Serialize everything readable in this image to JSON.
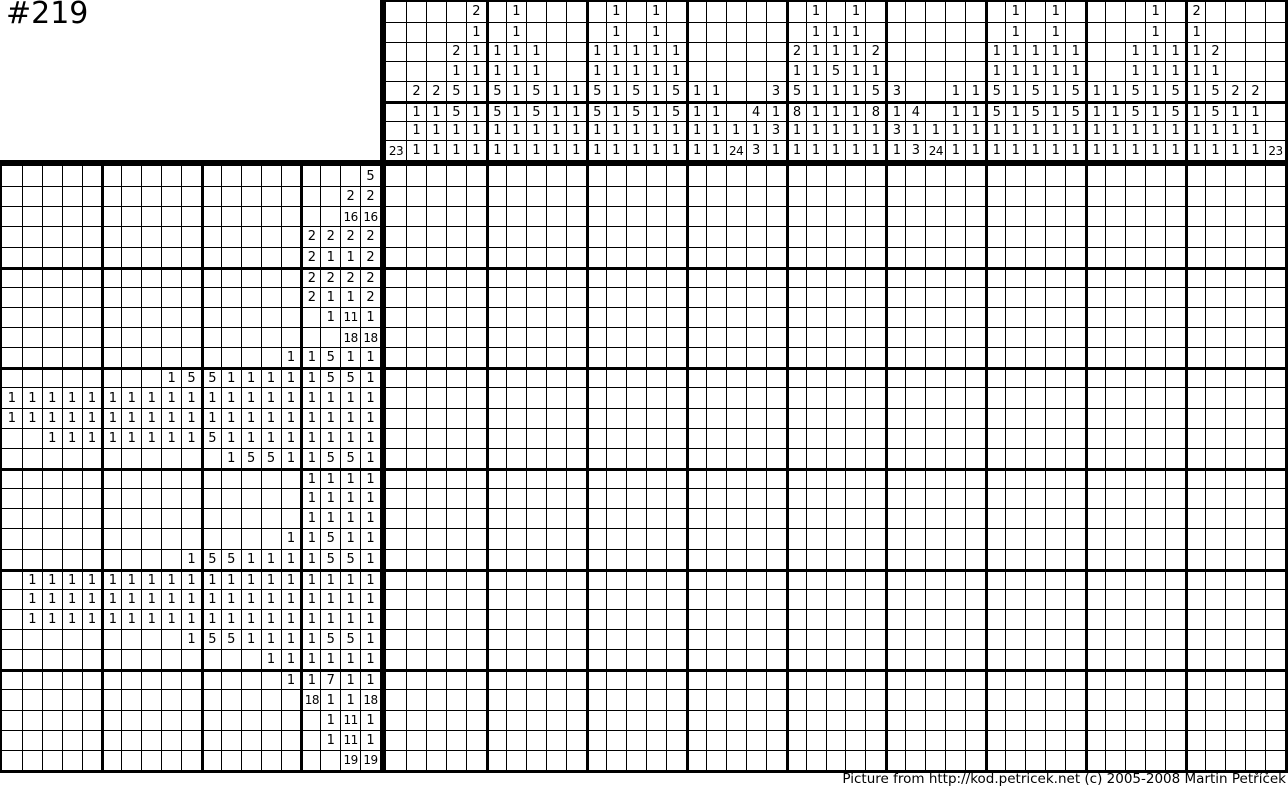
{
  "title": "#219",
  "footer": "Picture from http://kod.petricek.net (c) 2005-2008 Martin Petříček",
  "puzzle": {
    "grid_cols": 45,
    "grid_rows": 30,
    "column_clue_depth": 8,
    "row_clue_depth": 19,
    "colors": {
      "line": "#000000",
      "background": "#ffffff",
      "text": "#000000"
    },
    "column_clues": [
      [
        23
      ],
      [
        2,
        1,
        1,
        1
      ],
      [
        2,
        1,
        1,
        1
      ],
      [
        2,
        1,
        5,
        5,
        1,
        1
      ],
      [
        2,
        1,
        1,
        1,
        1,
        1,
        1,
        1
      ],
      [
        1,
        1,
        5,
        5,
        1,
        1
      ],
      [
        1,
        1,
        1,
        1,
        1,
        1,
        1,
        1
      ],
      [
        1,
        1,
        5,
        5,
        1,
        1
      ],
      [
        1,
        1,
        1,
        1
      ],
      [
        1,
        1,
        1,
        1
      ],
      [
        1,
        1,
        5,
        5,
        1,
        1
      ],
      [
        1,
        1,
        1,
        1,
        1,
        1,
        1,
        1
      ],
      [
        1,
        1,
        5,
        5,
        1,
        1
      ],
      [
        1,
        1,
        1,
        1,
        1,
        1,
        1,
        1
      ],
      [
        1,
        1,
        5,
        5,
        1,
        1
      ],
      [
        1,
        1,
        1,
        1
      ],
      [
        1,
        1,
        1,
        1
      ],
      [
        1,
        24
      ],
      [
        4,
        1,
        3
      ],
      [
        3,
        1,
        3,
        1
      ],
      [
        2,
        1,
        5,
        8,
        1,
        1
      ],
      [
        1,
        1,
        1,
        1,
        1,
        1,
        1,
        1
      ],
      [
        1,
        1,
        5,
        1,
        1,
        1,
        1
      ],
      [
        1,
        1,
        1,
        1,
        1,
        1,
        1,
        1
      ],
      [
        2,
        1,
        5,
        8,
        1,
        1
      ],
      [
        3,
        1,
        3,
        1
      ],
      [
        4,
        1,
        3
      ],
      [
        1,
        24
      ],
      [
        1,
        1,
        1,
        1
      ],
      [
        1,
        1,
        1,
        1
      ],
      [
        1,
        1,
        5,
        5,
        1,
        1
      ],
      [
        1,
        1,
        1,
        1,
        1,
        1,
        1,
        1
      ],
      [
        1,
        1,
        5,
        5,
        1,
        1
      ],
      [
        1,
        1,
        1,
        1,
        1,
        1,
        1,
        1
      ],
      [
        1,
        1,
        5,
        5,
        1,
        1
      ],
      [
        1,
        1,
        1,
        1
      ],
      [
        1,
        1,
        1,
        1
      ],
      [
        1,
        1,
        5,
        5,
        1,
        1
      ],
      [
        1,
        1,
        1,
        1,
        1,
        1,
        1,
        1
      ],
      [
        1,
        1,
        5,
        5,
        1,
        1
      ],
      [
        2,
        1,
        1,
        1,
        1,
        1,
        1,
        1
      ],
      [
        2,
        1,
        5,
        5,
        1,
        1
      ],
      [
        2,
        1,
        1,
        1
      ],
      [
        2,
        1,
        1,
        1
      ],
      [
        23
      ]
    ],
    "row_clues": [
      [
        5
      ],
      [
        2,
        2
      ],
      [
        16,
        16
      ],
      [
        2,
        2,
        2,
        2
      ],
      [
        2,
        1,
        1,
        2
      ],
      [
        2,
        2,
        2,
        2
      ],
      [
        2,
        1,
        1,
        2
      ],
      [
        1,
        11,
        1
      ],
      [
        18,
        18
      ],
      [
        1,
        1,
        5,
        1,
        1
      ],
      [
        1,
        5,
        5,
        1,
        1,
        1,
        1,
        1,
        5,
        5,
        1
      ],
      [
        1,
        1,
        1,
        1,
        1,
        1,
        1,
        1,
        1,
        1,
        1,
        1,
        1,
        1,
        1,
        1,
        1,
        1,
        1
      ],
      [
        1,
        1,
        1,
        1,
        1,
        1,
        1,
        1,
        1,
        1,
        1,
        1,
        1,
        1,
        1,
        1,
        1,
        1,
        1
      ],
      [
        1,
        1,
        1,
        1,
        1,
        1,
        1,
        1,
        5,
        1,
        1,
        1,
        1,
        1,
        1,
        1,
        1
      ],
      [
        1,
        5,
        5,
        1,
        1,
        5,
        5,
        1
      ],
      [
        1,
        1,
        1,
        1
      ],
      [
        1,
        1,
        1,
        1
      ],
      [
        1,
        1,
        1,
        1
      ],
      [
        1,
        1,
        5,
        1,
        1
      ],
      [
        1,
        5,
        5,
        1,
        1,
        1,
        1,
        5,
        5,
        1
      ],
      [
        1,
        1,
        1,
        1,
        1,
        1,
        1,
        1,
        1,
        1,
        1,
        1,
        1,
        1,
        1,
        1,
        1,
        1
      ],
      [
        1,
        1,
        1,
        1,
        1,
        1,
        1,
        1,
        1,
        1,
        1,
        1,
        1,
        1,
        1,
        1,
        1,
        1
      ],
      [
        1,
        1,
        1,
        1,
        1,
        1,
        1,
        1,
        1,
        1,
        1,
        1,
        1,
        1,
        1,
        1,
        1,
        1
      ],
      [
        1,
        5,
        5,
        1,
        1,
        1,
        1,
        5,
        5,
        1
      ],
      [
        1,
        1,
        1,
        1,
        1,
        1
      ],
      [
        1,
        1,
        7,
        1,
        1
      ],
      [
        18,
        1,
        1,
        18
      ],
      [
        1,
        11,
        1
      ],
      [
        1,
        11,
        1
      ],
      [
        19,
        19
      ],
      [
        9
      ]
    ]
  }
}
